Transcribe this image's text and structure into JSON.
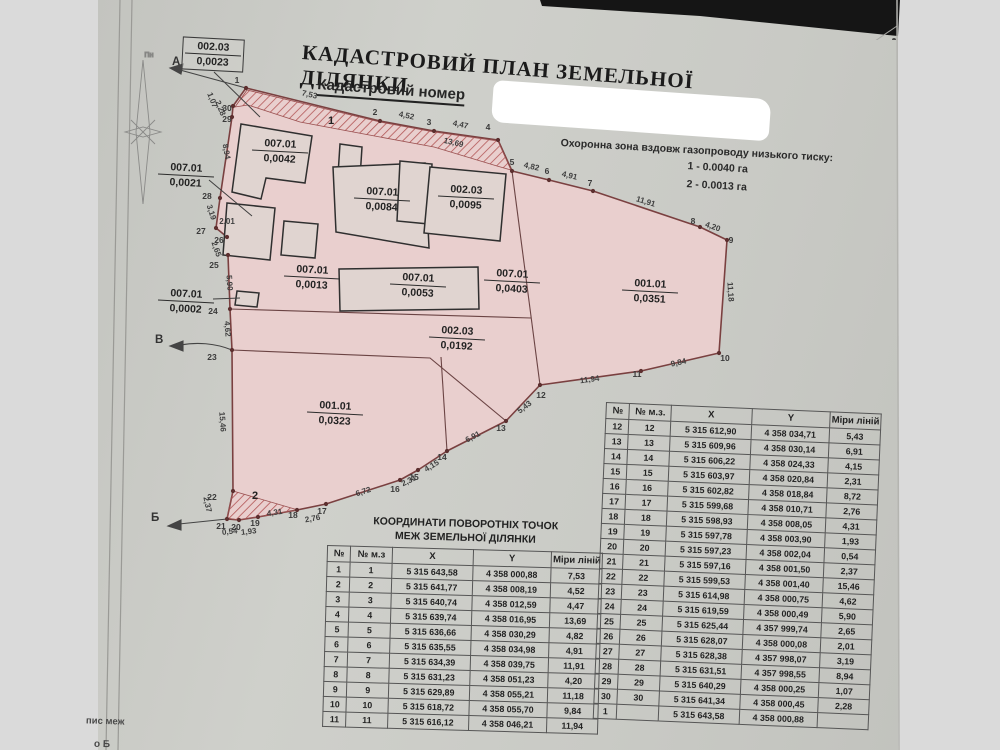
{
  "document": {
    "title": "КАДАСТРОВИЙ ПЛАН ЗЕМЕЛЬНОЇ ДІЛЯНКИ",
    "subtitle": "Кадастровий номер",
    "protection_zone": {
      "heading": "Охоронна зона вздовж газопроводу низького тиску:",
      "items": [
        "1 - 0.0040 га",
        "2 - 0.0013 га"
      ]
    },
    "bottom_fragments": [
      "пис меж",
      "о Б"
    ],
    "compass_label": "Пн"
  },
  "map": {
    "direction_labels": {
      "a": "А",
      "v": "В",
      "b": "Б"
    },
    "zone_labels": [
      "1",
      "2"
    ],
    "parcels": [
      {
        "code": "002.03",
        "area": "0,0023"
      },
      {
        "code": "007.01",
        "area": "0,0042"
      },
      {
        "code": "007.01",
        "area": "0,0084"
      },
      {
        "code": "002.03",
        "area": "0,0095"
      },
      {
        "code": "007.01",
        "area": "0,0021"
      },
      {
        "code": "007.01",
        "area": "0,0013"
      },
      {
        "code": "007.01",
        "area": "0,0053"
      },
      {
        "code": "007.01",
        "area": "0,0403"
      },
      {
        "code": "001.01",
        "area": "0,0351"
      },
      {
        "code": "007.01",
        "area": "0,0002"
      },
      {
        "code": "002.03",
        "area": "0,0192"
      },
      {
        "code": "001.01",
        "area": "0,0323"
      }
    ],
    "point_numbers": [
      "1",
      "2",
      "3",
      "4",
      "5",
      "6",
      "7",
      "8",
      "9",
      "10",
      "11",
      "12",
      "13",
      "14",
      "15",
      "16",
      "17",
      "18",
      "19",
      "20",
      "21",
      "22",
      "23",
      "24",
      "25",
      "26",
      "27",
      "28",
      "29",
      "30"
    ],
    "edge_measures": [
      "7,53",
      "4,52",
      "4,47",
      "13,69",
      "4,82",
      "4,91",
      "11,91",
      "4,20",
      "11,18",
      "9,84",
      "11,94",
      "5,43",
      "6,91",
      "4,15",
      "2,31",
      "6,72",
      "2,76",
      "4,31",
      "1,93",
      "0,54",
      "2,37",
      "15,46",
      "4,62",
      "5,90",
      "2,65",
      "2,01",
      "3,19",
      "8,94",
      "1,07",
      "2,28"
    ]
  },
  "coords_table_left": {
    "title_line1": "КООРДИНАТИ ПОВОРОТНІХ ТОЧОК",
    "title_line2": "МЕЖ ЗЕМЕЛЬНОЇ ДІЛЯНКИ",
    "headers": [
      "№",
      "№ м.з",
      "X",
      "Y",
      "Міри ліній"
    ],
    "rows": [
      [
        "1",
        "1",
        "5 315 643,58",
        "4 358 000,88",
        "7,53"
      ],
      [
        "2",
        "2",
        "5 315 641,77",
        "4 358 008,19",
        "4,52"
      ],
      [
        "3",
        "3",
        "5 315 640,74",
        "4 358 012,59",
        "4,47"
      ],
      [
        "4",
        "4",
        "5 315 639,74",
        "4 358 016,95",
        "13,69"
      ],
      [
        "5",
        "5",
        "5 315 636,66",
        "4 358 030,29",
        "4,82"
      ],
      [
        "6",
        "6",
        "5 315 635,55",
        "4 358 034,98",
        "4,91"
      ],
      [
        "7",
        "7",
        "5 315 634,39",
        "4 358 039,75",
        "11,91"
      ],
      [
        "8",
        "8",
        "5 315 631,23",
        "4 358 051,23",
        "4,20"
      ],
      [
        "9",
        "9",
        "5 315 629,89",
        "4 358 055,21",
        "11,18"
      ],
      [
        "10",
        "10",
        "5 315 618,72",
        "4 358 055,70",
        "9,84"
      ],
      [
        "11",
        "11",
        "5 315 616,12",
        "4 358 046,21",
        "11,94"
      ]
    ]
  },
  "coords_table_right": {
    "headers": [
      "№",
      "№ м.з.",
      "X",
      "Y",
      "Міри ліній"
    ],
    "rows": [
      [
        "12",
        "12",
        "5 315 612,90",
        "4 358 034,71",
        "5,43"
      ],
      [
        "13",
        "13",
        "5 315 609,96",
        "4 358 030,14",
        "6,91"
      ],
      [
        "14",
        "14",
        "5 315 606,22",
        "4 358 024,33",
        "4,15"
      ],
      [
        "15",
        "15",
        "5 315 603,97",
        "4 358 020,84",
        "2,31"
      ],
      [
        "16",
        "16",
        "5 315 602,82",
        "4 358 018,84",
        "8,72"
      ],
      [
        "17",
        "17",
        "5 315 599,68",
        "4 358 010,71",
        "2,76"
      ],
      [
        "18",
        "18",
        "5 315 598,93",
        "4 358 008,05",
        "4,31"
      ],
      [
        "19",
        "19",
        "5 315 597,78",
        "4 358 003,90",
        "1,93"
      ],
      [
        "20",
        "20",
        "5 315 597,23",
        "4 358 002,04",
        "0,54"
      ],
      [
        "21",
        "21",
        "5 315 597,16",
        "4 358 001,50",
        "2,37"
      ],
      [
        "22",
        "22",
        "5 315 599,53",
        "4 358 001,40",
        "15,46"
      ],
      [
        "23",
        "23",
        "5 315 614,98",
        "4 358 000,75",
        "4,62"
      ],
      [
        "24",
        "24",
        "5 315 619,59",
        "4 358 000,49",
        "5,90"
      ],
      [
        "25",
        "25",
        "5 315 625,44",
        "4 357 999,74",
        "2,65"
      ],
      [
        "26",
        "26",
        "5 315 628,07",
        "4 358 000,08",
        "2,01"
      ],
      [
        "27",
        "27",
        "5 315 628,38",
        "4 357 998,07",
        "3,19"
      ],
      [
        "28",
        "28",
        "5 315 631,51",
        "4 357 998,55",
        "8,94"
      ],
      [
        "29",
        "29",
        "5 315 640,29",
        "4 358 000,25",
        "1,07"
      ],
      [
        "30",
        "30",
        "5 315 641,34",
        "4 358 000,45",
        "2,28"
      ],
      [
        "1",
        "",
        "5 315 643,58",
        "4 358 000,88",
        ""
      ]
    ]
  },
  "colors": {
    "background": "#dadada",
    "page": "#cbccc7",
    "plot_fill": "#e9cfce",
    "plot_outline": "#7a4040",
    "hatch": "#b35757",
    "ink": "#262626",
    "table_line": "#565656"
  }
}
